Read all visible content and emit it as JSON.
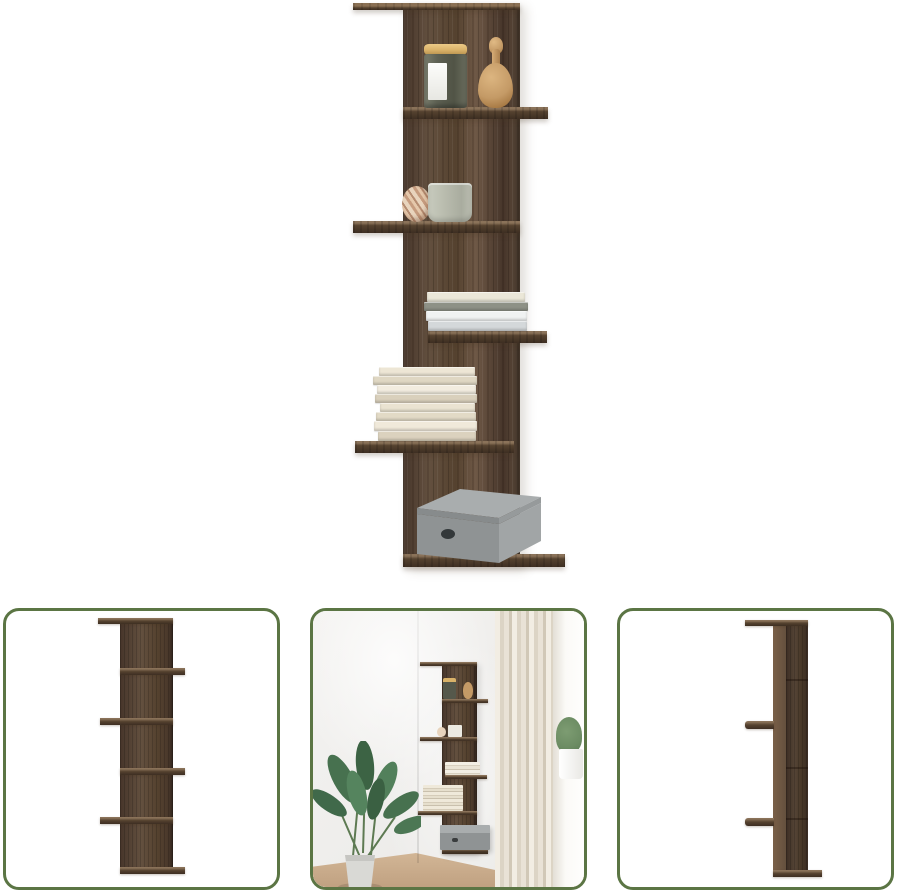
{
  "canvas": {
    "width": 900,
    "height": 894,
    "background": "#ffffff"
  },
  "colors": {
    "bg": "#ffffff",
    "wood_base": "#63503f",
    "wood_shade": "#55422f",
    "wood_dark": "#46352a",
    "wood_light": "#6e5846",
    "wood_face": "#3d2e22",
    "wood_edge": "#8a7259",
    "wood_top": "#8a7054",
    "green_border": "#5b7544",
    "box_top": "#a9adae",
    "box_front": "#8f9394",
    "box_side": "#a1a5a6",
    "box_hole": "#33383a",
    "jar_lid": "#d9b269",
    "jar_body": "#5f6254",
    "figurine": "#c49a66",
    "cup": "#b9bcae",
    "ball_a": "#e8d4bd",
    "ball_b": "#c69c7f",
    "curtain": "#e9e2d6",
    "wall": "#efeeec",
    "floor": "#d2b696",
    "plant_green": "#47714f",
    "plant_light": "#6c8c63"
  },
  "gallery": {
    "main": {
      "view": "front-view-decorated"
    },
    "thumbnails": [
      {
        "view": "front-view-empty"
      },
      {
        "view": "room-scene"
      },
      {
        "view": "side-view"
      }
    ]
  },
  "decor": {
    "book_stack_small": [
      {
        "x": 3,
        "w": 98,
        "h": 10,
        "c": "#ebe7d8"
      },
      {
        "x": 0,
        "w": 104,
        "h": 9,
        "c": "#8e9186"
      },
      {
        "x": 2,
        "w": 101,
        "h": 10,
        "c": "#f0f2f2"
      },
      {
        "x": 4,
        "w": 99,
        "h": 10,
        "c": "#d4d8da"
      }
    ],
    "book_stack_large": [
      {
        "x": 6,
        "w": 96,
        "h": 9,
        "c": "#ede6d5"
      },
      {
        "x": 0,
        "w": 104,
        "h": 9,
        "c": "#dfd7c3"
      },
      {
        "x": 4,
        "w": 99,
        "h": 9,
        "c": "#f2ecdf"
      },
      {
        "x": 2,
        "w": 102,
        "h": 9,
        "c": "#d9d0bc"
      },
      {
        "x": 7,
        "w": 95,
        "h": 9,
        "c": "#eae3d1"
      },
      {
        "x": 3,
        "w": 100,
        "h": 9,
        "c": "#e2dac6"
      },
      {
        "x": 1,
        "w": 103,
        "h": 10,
        "c": "#f0e9da"
      },
      {
        "x": 5,
        "w": 98,
        "h": 10,
        "c": "#dbd2be"
      }
    ]
  }
}
